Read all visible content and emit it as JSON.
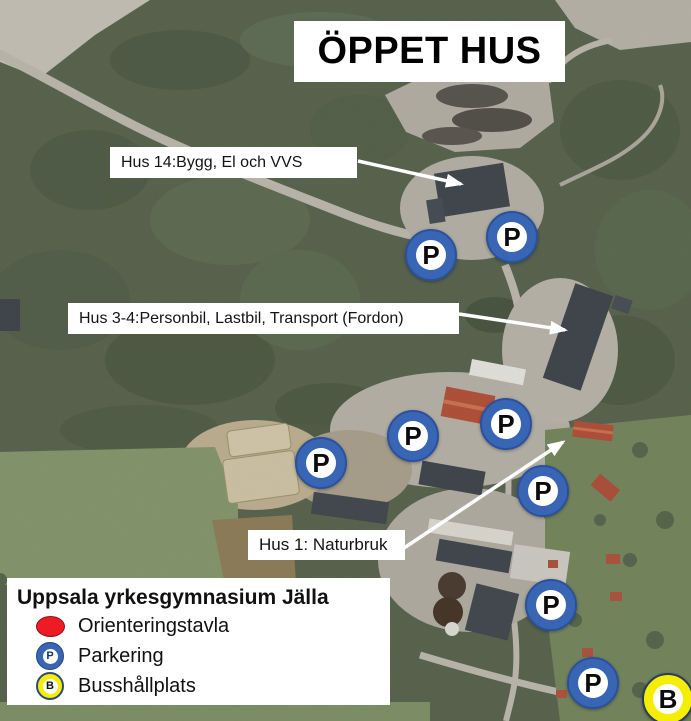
{
  "title": "ÖPPET HUS",
  "building_labels": [
    {
      "id": "hus14",
      "text": "Hus 14:Bygg, El och VVS"
    },
    {
      "id": "hus34",
      "text": "Hus 3-4:Personbil, Lastbil, Transport (Fordon)"
    },
    {
      "id": "hus1",
      "text": "Hus 1: Naturbruk"
    }
  ],
  "legend": {
    "title": "Uppsala yrkesgymnasium Jälla",
    "items": [
      {
        "label": "Orienteringstavla",
        "icon": "red-oval",
        "color": "#ee1b24"
      },
      {
        "label": "Parkering",
        "icon": "parking-circle",
        "color": "#3866b4",
        "letter": "P"
      },
      {
        "label": "Busshållplats",
        "icon": "bus-circle",
        "color": "#f6ee00",
        "letter": "B"
      }
    ]
  },
  "map_markers": {
    "parking": {
      "letter": "P",
      "color": "#3866b4",
      "positions": [
        {
          "x": 431,
          "y": 255
        },
        {
          "x": 512,
          "y": 237
        },
        {
          "x": 413,
          "y": 436
        },
        {
          "x": 506,
          "y": 424
        },
        {
          "x": 321,
          "y": 463
        },
        {
          "x": 543,
          "y": 491
        },
        {
          "x": 551,
          "y": 605
        },
        {
          "x": 593,
          "y": 683
        }
      ]
    },
    "bus": {
      "letter": "B",
      "color": "#f6ee00",
      "positions": [
        {
          "x": 668,
          "y": 699
        }
      ]
    }
  },
  "arrows": {
    "color": "#ffffff",
    "lines": [
      {
        "from": {
          "x": 358,
          "y": 161
        },
        "to": {
          "x": 461,
          "y": 184
        },
        "points_to": "hus14"
      },
      {
        "from": {
          "x": 459,
          "y": 314
        },
        "to": {
          "x": 565,
          "y": 330
        },
        "points_to": "hus34"
      },
      {
        "from": {
          "x": 404,
          "y": 548
        },
        "to": {
          "x": 563,
          "y": 442
        },
        "points_to": "hus1"
      }
    ]
  }
}
